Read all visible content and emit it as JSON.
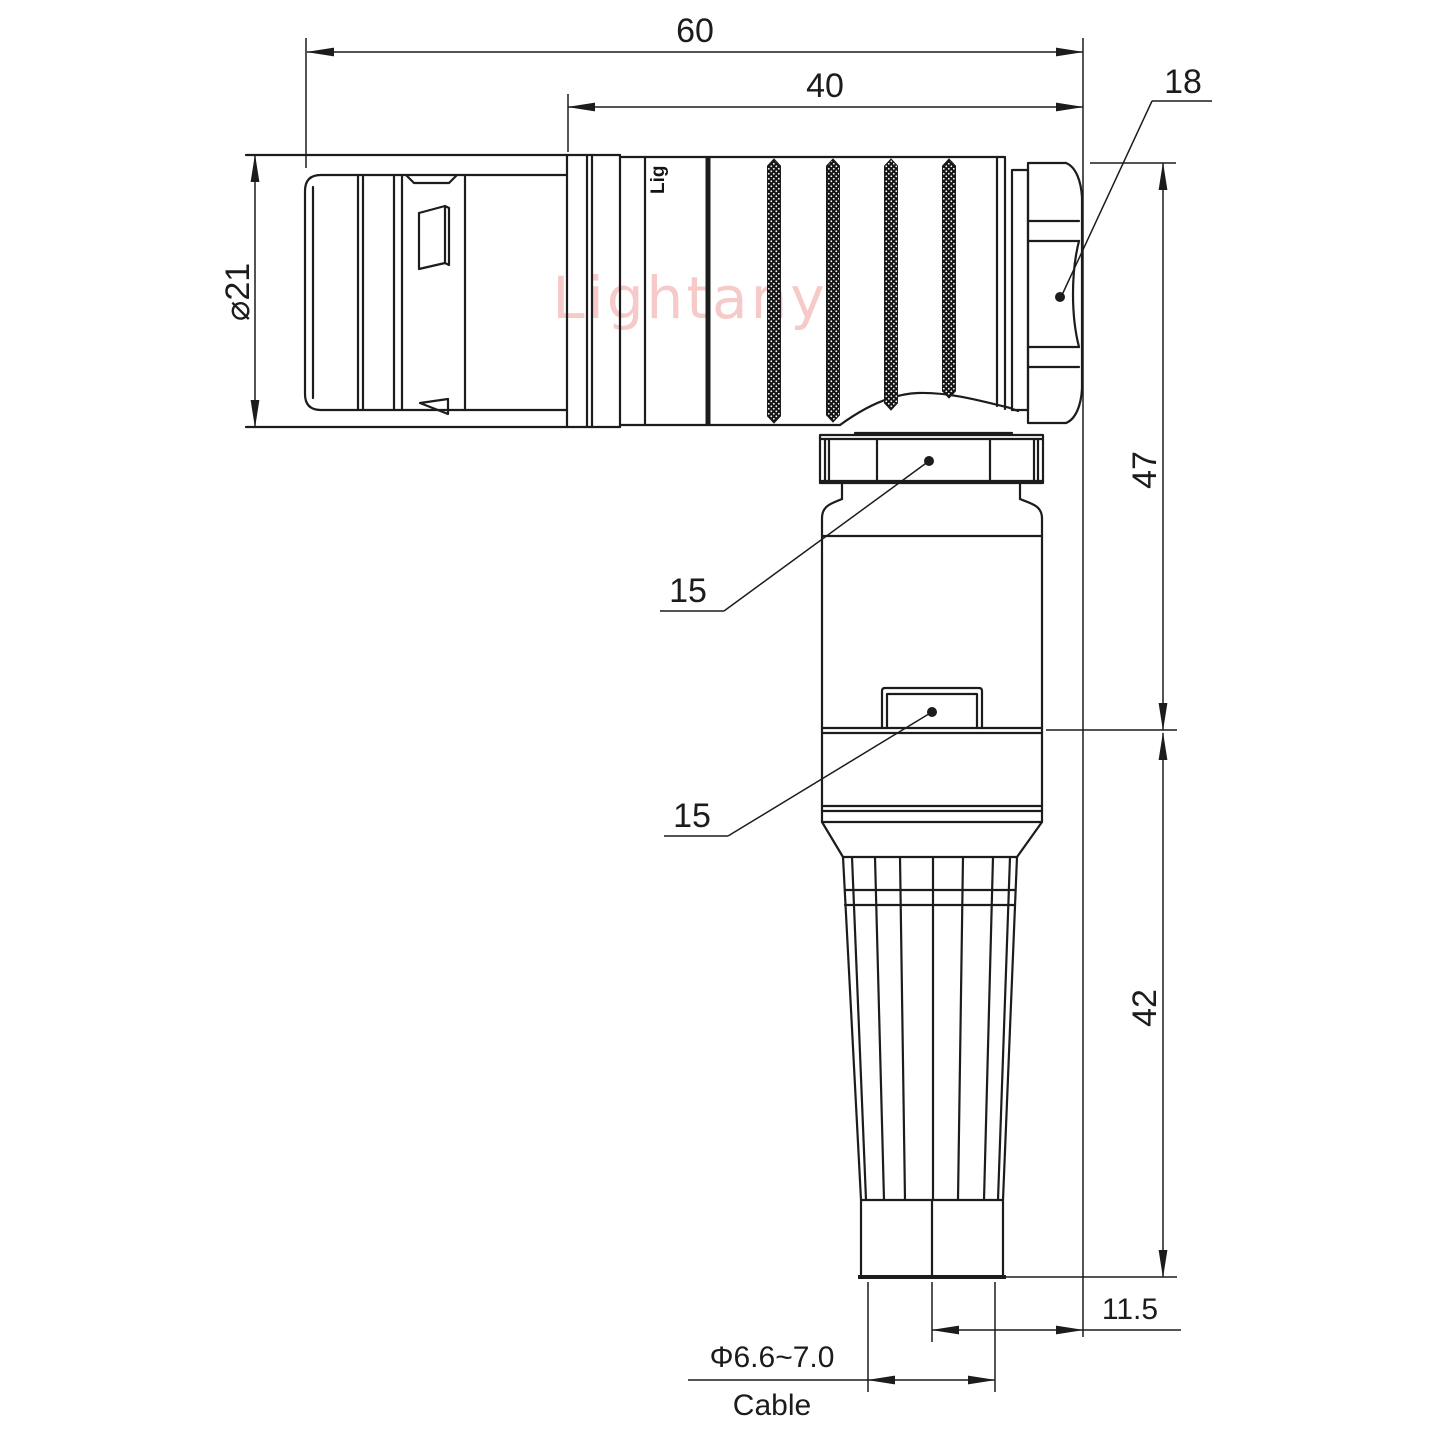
{
  "drawing": {
    "watermark": "Lightany",
    "body_logo": "Lig",
    "dimensions": {
      "overall_length": "60",
      "body_length": "40",
      "nut_size": "18",
      "shell_diameter": "⌀21",
      "upper_height": "47",
      "lower_height": "42",
      "collar_width": "15",
      "body_width": "15",
      "cable_offset": "11.5",
      "cable_diameter": "Φ6.6~7.0",
      "cable_label": "Cable"
    },
    "colors": {
      "line": "#1c1c1c",
      "watermark": "#f7caca",
      "background": "#ffffff"
    }
  }
}
